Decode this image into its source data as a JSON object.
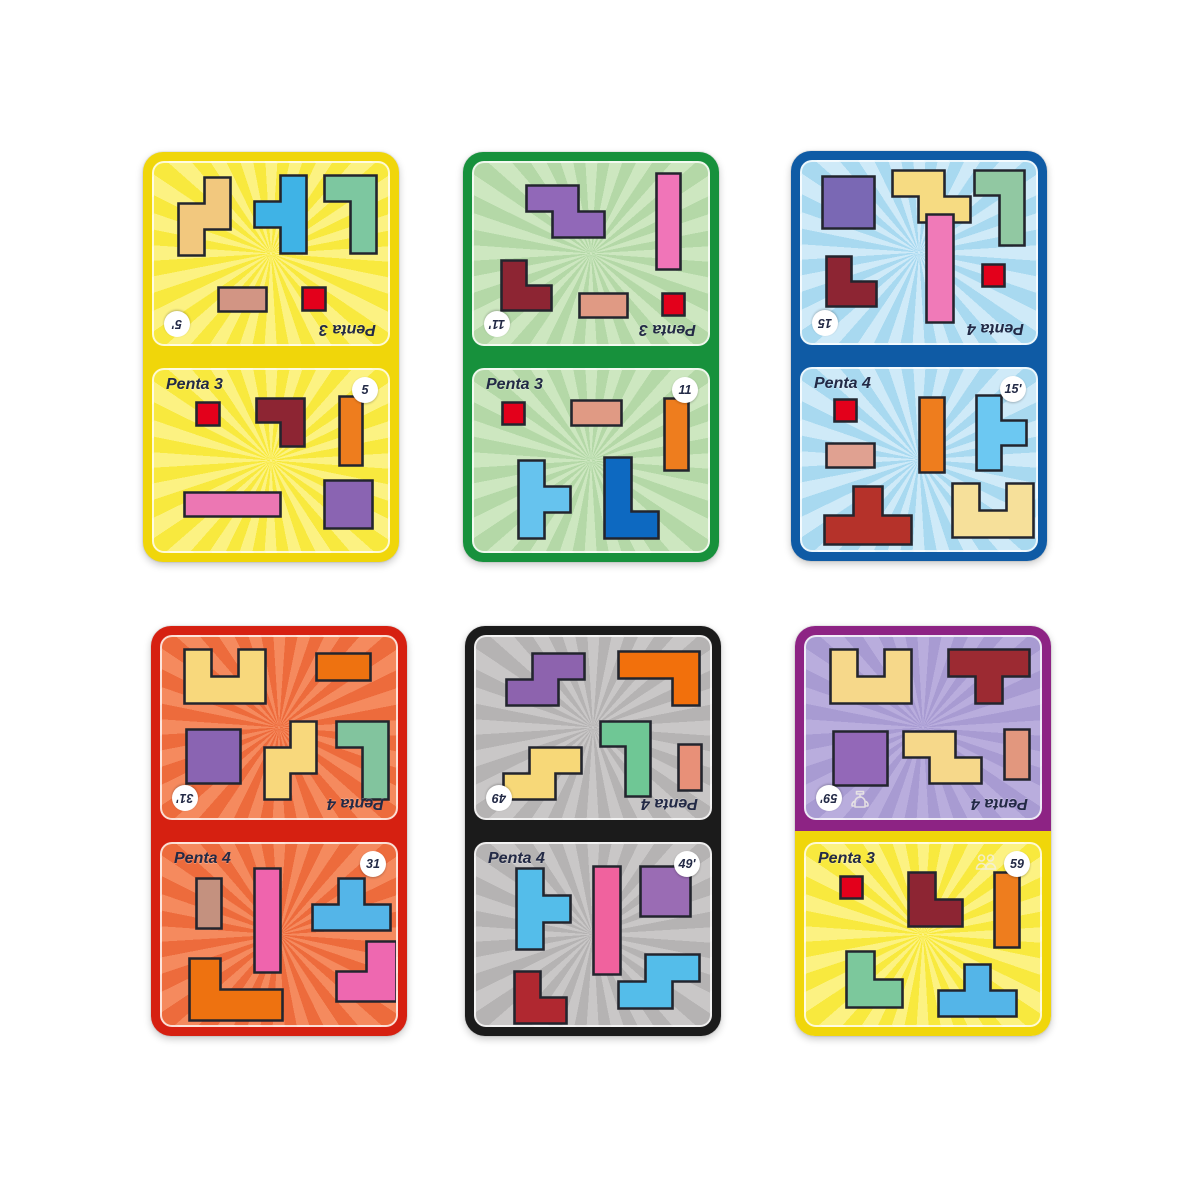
{
  "page": {
    "background": "#ffffff"
  },
  "style": {
    "piece_outline": "#23252e",
    "label_color": "#232a46",
    "badge_bg": "#ffffff",
    "icon_color": "#f2efe6"
  },
  "shapes": {
    "sq1": [
      [
        0,
        0
      ],
      [
        1,
        0
      ],
      [
        1,
        1
      ],
      [
        0,
        1
      ]
    ],
    "sq2": [
      [
        0,
        0
      ],
      [
        2,
        0
      ],
      [
        2,
        2
      ],
      [
        0,
        2
      ]
    ],
    "r2h": [
      [
        0,
        0
      ],
      [
        2,
        0
      ],
      [
        2,
        1
      ],
      [
        0,
        1
      ]
    ],
    "r2v": [
      [
        0,
        0
      ],
      [
        1,
        0
      ],
      [
        1,
        2
      ],
      [
        0,
        2
      ]
    ],
    "r3v": [
      [
        0,
        0
      ],
      [
        1,
        0
      ],
      [
        1,
        3
      ],
      [
        0,
        3
      ]
    ],
    "r4h": [
      [
        0,
        0
      ],
      [
        4,
        0
      ],
      [
        4,
        1
      ],
      [
        0,
        1
      ]
    ],
    "r4v": [
      [
        0,
        0
      ],
      [
        1,
        0
      ],
      [
        1,
        4
      ],
      [
        0,
        4
      ]
    ],
    "l_tr": [
      [
        0,
        0
      ],
      [
        2,
        0
      ],
      [
        2,
        2
      ],
      [
        1,
        2
      ],
      [
        1,
        1
      ],
      [
        0,
        1
      ]
    ],
    "l_dr": [
      [
        0,
        0
      ],
      [
        1,
        0
      ],
      [
        1,
        1
      ],
      [
        2,
        1
      ],
      [
        2,
        2
      ],
      [
        0,
        2
      ]
    ],
    "l_dl": [
      [
        1,
        0
      ],
      [
        2,
        0
      ],
      [
        2,
        2
      ],
      [
        0,
        2
      ],
      [
        0,
        1
      ],
      [
        1,
        1
      ]
    ],
    "j4": [
      [
        0,
        0
      ],
      [
        2,
        0
      ],
      [
        2,
        3
      ],
      [
        1,
        3
      ],
      [
        1,
        1
      ],
      [
        0,
        1
      ]
    ],
    "l4": [
      [
        0,
        0
      ],
      [
        1,
        0
      ],
      [
        1,
        2
      ],
      [
        2,
        2
      ],
      [
        2,
        3
      ],
      [
        0,
        3
      ]
    ],
    "s_v": [
      [
        1,
        0
      ],
      [
        2,
        0
      ],
      [
        2,
        2
      ],
      [
        1,
        2
      ],
      [
        1,
        3
      ],
      [
        0,
        3
      ],
      [
        0,
        1
      ],
      [
        1,
        1
      ]
    ],
    "s_h": [
      [
        0,
        0
      ],
      [
        2,
        0
      ],
      [
        2,
        1
      ],
      [
        3,
        1
      ],
      [
        3,
        2
      ],
      [
        1,
        2
      ],
      [
        1,
        1
      ],
      [
        0,
        1
      ]
    ],
    "z_h": [
      [
        1,
        0
      ],
      [
        3,
        0
      ],
      [
        3,
        1
      ],
      [
        2,
        1
      ],
      [
        2,
        2
      ],
      [
        0,
        2
      ],
      [
        0,
        1
      ],
      [
        1,
        1
      ]
    ],
    "t_l": [
      [
        1,
        0
      ],
      [
        2,
        0
      ],
      [
        2,
        3
      ],
      [
        1,
        3
      ],
      [
        1,
        2
      ],
      [
        0,
        2
      ],
      [
        0,
        1
      ],
      [
        1,
        1
      ]
    ],
    "t_r": [
      [
        0,
        0
      ],
      [
        1,
        0
      ],
      [
        1,
        1
      ],
      [
        2,
        1
      ],
      [
        2,
        2
      ],
      [
        1,
        2
      ],
      [
        1,
        3
      ],
      [
        0,
        3
      ]
    ],
    "t_u": [
      [
        1,
        0
      ],
      [
        2,
        0
      ],
      [
        2,
        1
      ],
      [
        3,
        1
      ],
      [
        3,
        2
      ],
      [
        0,
        2
      ],
      [
        0,
        1
      ],
      [
        1,
        1
      ]
    ],
    "t_d": [
      [
        0,
        0
      ],
      [
        3,
        0
      ],
      [
        3,
        1
      ],
      [
        2,
        1
      ],
      [
        2,
        2
      ],
      [
        1,
        2
      ],
      [
        1,
        1
      ],
      [
        0,
        1
      ]
    ],
    "u5": [
      [
        0,
        0
      ],
      [
        1,
        0
      ],
      [
        1,
        1
      ],
      [
        2,
        1
      ],
      [
        2,
        0
      ],
      [
        3,
        0
      ],
      [
        3,
        2
      ],
      [
        0,
        2
      ]
    ],
    "l3r": [
      [
        0,
        0
      ],
      [
        3,
        0
      ],
      [
        3,
        2
      ],
      [
        2,
        2
      ],
      [
        2,
        1
      ],
      [
        0,
        1
      ]
    ],
    "v3": [
      [
        0,
        0
      ],
      [
        1,
        0
      ],
      [
        1,
        1
      ],
      [
        3,
        1
      ],
      [
        3,
        2
      ],
      [
        0,
        2
      ]
    ]
  },
  "cards": [
    {
      "id": "yellow-5",
      "x": 143,
      "y": 152,
      "w": 256,
      "h": 410,
      "border_top": "#f0d60a",
      "border_bottom": "#f0d60a",
      "halves": [
        {
          "rotated": true,
          "bg": "#f8e93e",
          "ray": "#fcf282",
          "label": "Penta 3",
          "badge": "5'",
          "pieces": [
            {
              "shape": "s_v",
              "color": "#f2c87e",
              "x": 22,
              "y": 12,
              "s": 26
            },
            {
              "shape": "t_l",
              "color": "#3fb3e6",
              "x": 98,
              "y": 10,
              "s": 26
            },
            {
              "shape": "j4",
              "color": "#7dc7a0",
              "x": 168,
              "y": 10,
              "s": 26
            },
            {
              "shape": "r2h",
              "color": "#d29584",
              "x": 62,
              "y": 122,
              "s": 24
            },
            {
              "shape": "sq1",
              "color": "#e3001b",
              "x": 146,
              "y": 122,
              "s": 23
            }
          ]
        },
        {
          "rotated": false,
          "bg": "#f8e93e",
          "ray": "#fcf282",
          "label": "Penta 3",
          "badge": "5",
          "pieces": [
            {
              "shape": "sq1",
              "color": "#e3001b",
              "x": 40,
              "y": 30,
              "s": 23
            },
            {
              "shape": "l_tr",
              "color": "#8d2533",
              "x": 100,
              "y": 26,
              "s": 24
            },
            {
              "shape": "r3v",
              "color": "#ee7d1e",
              "x": 183,
              "y": 24,
              "s": 23
            },
            {
              "shape": "r4h",
              "color": "#ec77b3",
              "x": 28,
              "y": 120,
              "s": 24
            },
            {
              "shape": "sq2",
              "color": "#8a64b2",
              "x": 168,
              "y": 108,
              "s": 24
            }
          ]
        }
      ]
    },
    {
      "id": "green-11",
      "x": 463,
      "y": 152,
      "w": 256,
      "h": 410,
      "border_top": "#17913c",
      "border_bottom": "#17913c",
      "halves": [
        {
          "rotated": true,
          "bg": "#b4d8a7",
          "ray": "#cde7c0",
          "label": "Penta 3",
          "badge": "11'",
          "pieces": [
            {
              "shape": "s_h",
              "color": "#9168b8",
              "x": 50,
              "y": 20,
              "s": 26
            },
            {
              "shape": "r4v",
              "color": "#f075b8",
              "x": 180,
              "y": 8,
              "s": 24
            },
            {
              "shape": "l_dr",
              "color": "#8d2533",
              "x": 25,
              "y": 95,
              "s": 25
            },
            {
              "shape": "r2h",
              "color": "#e09a84",
              "x": 103,
              "y": 128,
              "s": 24
            },
            {
              "shape": "sq1",
              "color": "#e3001b",
              "x": 186,
              "y": 128,
              "s": 22
            }
          ]
        },
        {
          "rotated": false,
          "bg": "#b4d8a7",
          "ray": "#cde7c0",
          "label": "Penta 3",
          "badge": "11",
          "pieces": [
            {
              "shape": "sq1",
              "color": "#e3001b",
              "x": 26,
              "y": 30,
              "s": 22
            },
            {
              "shape": "r2h",
              "color": "#e09a84",
              "x": 95,
              "y": 28,
              "s": 25
            },
            {
              "shape": "r3v",
              "color": "#ee7d1e",
              "x": 188,
              "y": 26,
              "s": 24
            },
            {
              "shape": "t_r",
              "color": "#66c3ee",
              "x": 42,
              "y": 88,
              "s": 26
            },
            {
              "shape": "l4",
              "color": "#0d69c1",
              "x": 128,
              "y": 85,
              "s": 27
            }
          ]
        }
      ]
    },
    {
      "id": "blue-15",
      "x": 791,
      "y": 151,
      "w": 256,
      "h": 410,
      "border_top": "#0f5ba5",
      "border_bottom": "#0f5ba5",
      "halves": [
        {
          "rotated": true,
          "bg": "#a8d9f0",
          "ray": "#cfeaf8",
          "label": "Penta 4",
          "badge": "15",
          "pieces": [
            {
              "shape": "sq2",
              "color": "#7a68b4",
              "x": 18,
              "y": 12,
              "s": 26
            },
            {
              "shape": "s_h",
              "color": "#f6db82",
              "x": 88,
              "y": 6,
              "s": 26
            },
            {
              "shape": "j4",
              "color": "#91c8a2",
              "x": 170,
              "y": 6,
              "s": 25
            },
            {
              "shape": "l_dr",
              "color": "#8d2533",
              "x": 22,
              "y": 92,
              "s": 25
            },
            {
              "shape": "r4v",
              "color": "#f07ab8",
              "x": 122,
              "y": 50,
              "s": 27
            },
            {
              "shape": "sq1",
              "color": "#e3001b",
              "x": 178,
              "y": 100,
              "s": 22
            }
          ]
        },
        {
          "rotated": false,
          "bg": "#a8d9f0",
          "ray": "#cfeaf8",
          "label": "Penta 4",
          "badge": "15'",
          "pieces": [
            {
              "shape": "sq1",
              "color": "#e3001b",
              "x": 30,
              "y": 28,
              "s": 22
            },
            {
              "shape": "r2h",
              "color": "#e0a191",
              "x": 22,
              "y": 72,
              "s": 24
            },
            {
              "shape": "r3v",
              "color": "#ee7d1e",
              "x": 115,
              "y": 26,
              "s": 25
            },
            {
              "shape": "t_r",
              "color": "#6cc8f2",
              "x": 172,
              "y": 24,
              "s": 25
            },
            {
              "shape": "t_u",
              "color": "#b5322a",
              "x": 20,
              "y": 115,
              "s": 29
            },
            {
              "shape": "u5",
              "color": "#f6e09a",
              "x": 148,
              "y": 112,
              "s": 27
            }
          ]
        }
      ]
    },
    {
      "id": "red-31",
      "x": 151,
      "y": 626,
      "w": 256,
      "h": 410,
      "border_top": "#d62011",
      "border_bottom": "#d62011",
      "halves": [
        {
          "rotated": true,
          "bg": "#ed6b3c",
          "ray": "#f58a5e",
          "label": "Penta 4",
          "badge": "31'",
          "pieces": [
            {
              "shape": "u5",
              "color": "#f8d87c",
              "x": 20,
              "y": 10,
              "s": 27
            },
            {
              "shape": "r2h",
              "color": "#ee7210",
              "x": 152,
              "y": 14,
              "s": 27
            },
            {
              "shape": "sq2",
              "color": "#8a64b2",
              "x": 22,
              "y": 90,
              "s": 27
            },
            {
              "shape": "s_v",
              "color": "#f8d87c",
              "x": 100,
              "y": 82,
              "s": 26
            },
            {
              "shape": "j4",
              "color": "#82c49e",
              "x": 172,
              "y": 82,
              "s": 26
            }
          ]
        },
        {
          "rotated": false,
          "bg": "#ed6b3c",
          "ray": "#f58a5e",
          "label": "Penta 4",
          "badge": "31",
          "pieces": [
            {
              "shape": "r2v",
              "color": "#c4917f",
              "x": 32,
              "y": 32,
              "s": 25
            },
            {
              "shape": "r4v",
              "color": "#ef64ad",
              "x": 90,
              "y": 22,
              "s": 26
            },
            {
              "shape": "t_u",
              "color": "#54b5e8",
              "x": 148,
              "y": 32,
              "s": 26
            },
            {
              "shape": "v3",
              "color": "#ee7210",
              "x": 25,
              "y": 112,
              "s": 31
            },
            {
              "shape": "l_dl",
              "color": "#ee68b0",
              "x": 172,
              "y": 95,
              "s": 30
            }
          ]
        }
      ]
    },
    {
      "id": "black-49",
      "x": 465,
      "y": 626,
      "w": 256,
      "h": 410,
      "border_top": "#1b1b1b",
      "border_bottom": "#1b1b1b",
      "halves": [
        {
          "rotated": true,
          "bg": "#b5b3b3",
          "ray": "#c9c7c7",
          "label": "Penta 4",
          "badge": "49",
          "pieces": [
            {
              "shape": "z_h",
              "color": "#8d63ae",
              "x": 28,
              "y": 14,
              "s": 26
            },
            {
              "shape": "l3r",
              "color": "#f2700c",
              "x": 140,
              "y": 12,
              "s": 27
            },
            {
              "shape": "z_h",
              "color": "#f7d878",
              "x": 25,
              "y": 108,
              "s": 26
            },
            {
              "shape": "j4",
              "color": "#6fc795",
              "x": 122,
              "y": 82,
              "s": 25
            },
            {
              "shape": "r2v",
              "color": "#e89078",
              "x": 200,
              "y": 105,
              "s": 23
            }
          ]
        },
        {
          "rotated": false,
          "bg": "#b5b3b3",
          "ray": "#c9c7c7",
          "label": "Penta 4",
          "badge": "49'",
          "pieces": [
            {
              "shape": "t_r",
              "color": "#54bdea",
              "x": 38,
              "y": 22,
              "s": 27
            },
            {
              "shape": "r4v",
              "color": "#f0629e",
              "x": 115,
              "y": 20,
              "s": 27
            },
            {
              "shape": "sq2",
              "color": "#9a6cb4",
              "x": 162,
              "y": 20,
              "s": 25
            },
            {
              "shape": "l_dr",
              "color": "#b02830",
              "x": 36,
              "y": 125,
              "s": 26
            },
            {
              "shape": "z_h",
              "color": "#54bdea",
              "x": 140,
              "y": 108,
              "s": 27
            }
          ]
        }
      ]
    },
    {
      "id": "purple-59",
      "x": 795,
      "y": 626,
      "w": 256,
      "h": 410,
      "border_top": "#8d2384",
      "border_bottom": "#f0d60a",
      "halves": [
        {
          "rotated": true,
          "bg": "#a89bd2",
          "ray": "#b9addd",
          "label": "Penta 4",
          "badge": "59'",
          "icon": "trophy",
          "pieces": [
            {
              "shape": "u5",
              "color": "#f6d88a",
              "x": 22,
              "y": 10,
              "s": 27
            },
            {
              "shape": "t_d",
              "color": "#9c2a32",
              "x": 140,
              "y": 10,
              "s": 27
            },
            {
              "shape": "sq2",
              "color": "#9368b8",
              "x": 25,
              "y": 92,
              "s": 27
            },
            {
              "shape": "s_h",
              "color": "#f6d88a",
              "x": 95,
              "y": 92,
              "s": 26
            },
            {
              "shape": "r2v",
              "color": "#e2977e",
              "x": 196,
              "y": 90,
              "s": 25
            }
          ]
        },
        {
          "rotated": false,
          "bg": "#f8e93e",
          "ray": "#fcf282",
          "label": "Penta 3",
          "badge": "59",
          "icon": "players",
          "pieces": [
            {
              "shape": "sq1",
              "color": "#e3001b",
              "x": 32,
              "y": 30,
              "s": 22
            },
            {
              "shape": "l_dr",
              "color": "#8d2533",
              "x": 100,
              "y": 26,
              "s": 27
            },
            {
              "shape": "r3v",
              "color": "#ee7d1e",
              "x": 186,
              "y": 26,
              "s": 25
            },
            {
              "shape": "l_dr",
              "color": "#7cc89c",
              "x": 38,
              "y": 105,
              "s": 28
            },
            {
              "shape": "t_u",
              "color": "#54b5e8",
              "x": 130,
              "y": 118,
              "s": 26
            }
          ]
        }
      ]
    }
  ]
}
